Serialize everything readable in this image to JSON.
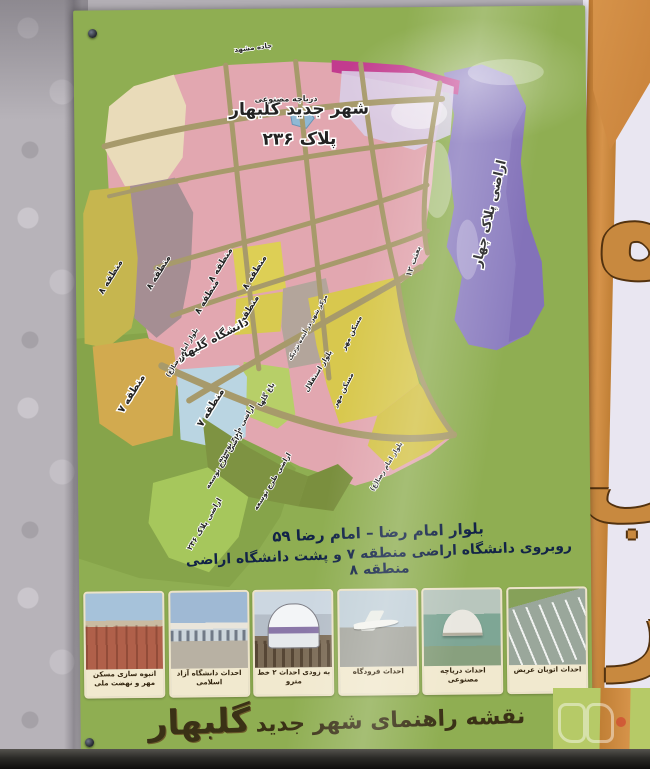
{
  "map": {
    "title_line1": "شهر جدید گلبهار",
    "title_line2": "پلاک ۲۳۶",
    "labels": {
      "plot_four": "اراضی پلاک چهار",
      "lake": "دریاچه مصنوعی",
      "road_mashhad": "جاده مشهد",
      "region8": "منطقه ۸",
      "region7": "منطقه ۷",
      "university": "دانشگاه گلبهار",
      "city_center": "مرکز شهر در آینده نزدیک",
      "flower_garden": "باغ گلها",
      "maskan_mehr": "مسکن مهر",
      "besat12": "بعثت ۱۲",
      "esteghlal": "بلوار استقلال",
      "imam_reza_blvd": "بلوار امام رضا(ع)",
      "development": "اراضی طرح توسعه",
      "plot236": "اراضی پلاک ۲۳۶"
    }
  },
  "address": {
    "line1": "بلوار امام رضا – امام رضا ۵۹",
    "line2": "روبروی دانشگاه اراضی منطقه ۷ و پشت دانشگاه اراضی منطقه ۸"
  },
  "photos": [
    {
      "caption": "انبوه سازی مسکن مهر و نهضت ملی"
    },
    {
      "caption": "احداث دانشگاه آزاد اسلامی"
    },
    {
      "caption": "به زودی احداث ۲ خط مترو"
    },
    {
      "caption": "احداث فرودگاه"
    },
    {
      "caption": "احداث دریاچه مصنوعی"
    },
    {
      "caption": "احداث اتوبان عریض"
    }
  ],
  "footer": {
    "prefix": "نقشه راهنمای شهر جدید",
    "city": "گلبهار"
  },
  "side": {
    "letter_top": "ه",
    "letter_mid": "ب",
    "letter_bottom": "ر"
  },
  "colors": {
    "poster_green": "#8fae52",
    "map_pink": "#e2a7b0",
    "road_tan": "#a79a6b",
    "purple_plot": "#8c7ec0",
    "magenta_strip": "#c23b8e",
    "cream_region": "#e9dbb9",
    "olive_region8": "#c6b64f",
    "mauve_region8": "#a58e93",
    "yellow_parcel": "#ddcf55",
    "gold_region7": "#d2aa4f",
    "cyan_region7": "#bad5e2",
    "tan_center": "#b3a59b",
    "flower_green": "#b7cf68",
    "dev_olive": "#7e9342",
    "plot236_green": "#a6c75c",
    "lake_blue": "#8fb9d5",
    "side_orange": "#d6934a",
    "accent_red": "#d0342c"
  }
}
